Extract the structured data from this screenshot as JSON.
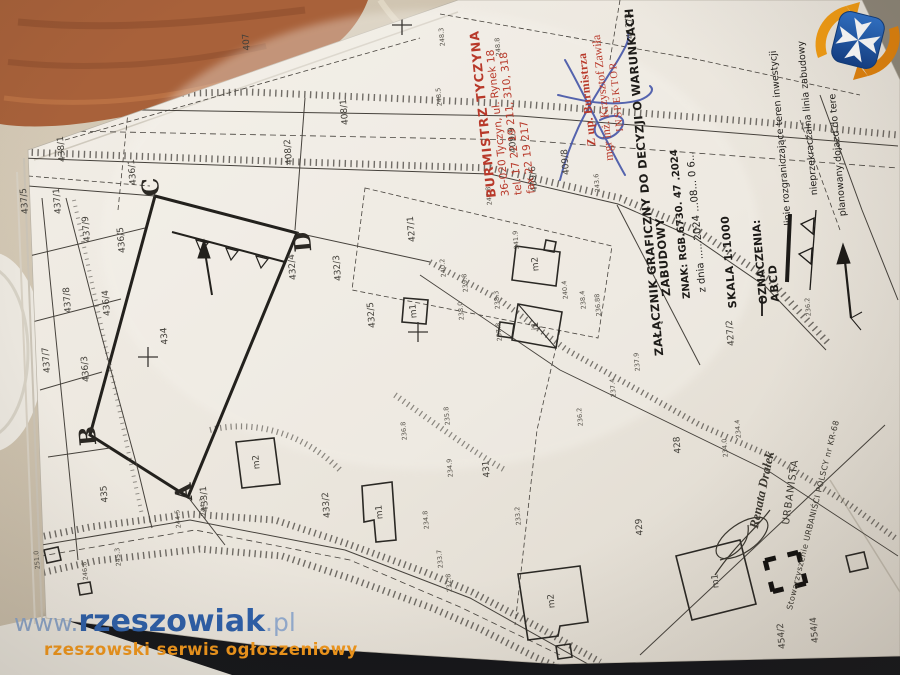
{
  "watermark": {
    "prefix": "www.",
    "name": "rzeszowiak",
    "suffix": ".pl",
    "tagline": "rzeszowski serwis ogłoszeniowy",
    "url_color": "#2d5fa8",
    "tagline_color": "#f0961b"
  },
  "logo": {
    "name": "rzeszow-crest-logo",
    "shield_color": "#1c55a8",
    "cross_color": "#ffffff",
    "swirl_color": "#f29c13"
  },
  "stamps": {
    "mayor_stamp": {
      "color": "#b8392a",
      "lines": [
        "BURMISTRZ TYCZYNA",
        "36-020 Tyczyn, ul. Rynek 18",
        "tel. 17 22 19 211, 310, 318",
        "fax 22 19 217"
      ]
    },
    "deputy_stamp": {
      "color": "#b8392a",
      "lines": [
        "Z up. Burmistrza",
        "mgr inż. Krzysztof Zawiła",
        "INSPEKTOR"
      ],
      "signature_color": "#4455a8"
    },
    "urbanist_stamp": {
      "name": "Renata Drałek",
      "role": "URBANISTA",
      "org": "Stowarzyszenie URBANIŚCI POLSCY nr KR-68"
    }
  },
  "title_block": {
    "line1": "ZAŁĄCZNIK GRAFICZNY DO DECYZJI O WARUNKACH",
    "line2": "ZABUDOWY",
    "znak": "ZNAK: RGB.6730. 47 .2024",
    "date_line": "z dnia ......2024 ...08... 0 6...",
    "scale": "SKALA 1:1000",
    "legend_header": "OZNACZENIA:",
    "abcd": "ABCD",
    "legend": [
      {
        "symbol": "boundary-thick-line",
        "label": "linie rozgraniczające teren inwestycji"
      },
      {
        "symbol": "triangle-line",
        "label": "nieprzekraczalna linia zabudowy"
      },
      {
        "symbol": "arrow",
        "label": "planowany dojazd do tere"
      }
    ]
  },
  "map": {
    "scale_text": "1:1000",
    "corner_letters": [
      {
        "t": "A",
        "x": 184,
        "y": 492
      },
      {
        "t": "B",
        "x": 88,
        "y": 436
      },
      {
        "t": "C",
        "x": 151,
        "y": 187
      },
      {
        "t": "D",
        "x": 303,
        "y": 242
      }
    ],
    "parcel_labels": [
      {
        "t": "407",
        "x": 247,
        "y": 42
      },
      {
        "t": "408/2",
        "x": 289,
        "y": 152
      },
      {
        "t": "408/1",
        "x": 345,
        "y": 112
      },
      {
        "t": "409/9",
        "x": 513,
        "y": 140
      },
      {
        "t": "409/6",
        "x": 534,
        "y": 179
      },
      {
        "t": "409/8",
        "x": 566,
        "y": 162
      },
      {
        "t": "412/2",
        "x": 630,
        "y": 26
      },
      {
        "t": "427/1",
        "x": 412,
        "y": 229
      },
      {
        "t": "427/2",
        "x": 731,
        "y": 333
      },
      {
        "t": "428",
        "x": 678,
        "y": 445
      },
      {
        "t": "429",
        "x": 640,
        "y": 527
      },
      {
        "t": "431",
        "x": 487,
        "y": 469
      },
      {
        "t": "432/3",
        "x": 338,
        "y": 268
      },
      {
        "t": "432/4",
        "x": 293,
        "y": 267
      },
      {
        "t": "432/5",
        "x": 372,
        "y": 315
      },
      {
        "t": "433/1",
        "x": 205,
        "y": 499
      },
      {
        "t": "433/2",
        "x": 327,
        "y": 505
      },
      {
        "t": "434",
        "x": 165,
        "y": 336
      },
      {
        "t": "435",
        "x": 105,
        "y": 494
      },
      {
        "t": "436/1",
        "x": 133,
        "y": 172
      },
      {
        "t": "436/3",
        "x": 86,
        "y": 369
      },
      {
        "t": "436/4",
        "x": 107,
        "y": 303
      },
      {
        "t": "436/5",
        "x": 122,
        "y": 240
      },
      {
        "t": "437/1",
        "x": 58,
        "y": 201
      },
      {
        "t": "437/5",
        "x": 25,
        "y": 201
      },
      {
        "t": "437/7",
        "x": 47,
        "y": 360
      },
      {
        "t": "437/8",
        "x": 68,
        "y": 300
      },
      {
        "t": "437/9",
        "x": 87,
        "y": 229
      },
      {
        "t": "438/1",
        "x": 62,
        "y": 149
      },
      {
        "t": "454/2",
        "x": 782,
        "y": 636
      },
      {
        "t": "454/4",
        "x": 815,
        "y": 630
      }
    ],
    "elevation_labels": [
      {
        "t": "248.3",
        "x": 442,
        "y": 37
      },
      {
        "t": "248.8",
        "x": 498,
        "y": 47
      },
      {
        "t": "248.5",
        "x": 439,
        "y": 97
      },
      {
        "t": "247.8",
        "x": 489,
        "y": 196
      },
      {
        "t": "243.6",
        "x": 597,
        "y": 183
      },
      {
        "t": "241.9",
        "x": 516,
        "y": 240
      },
      {
        "t": "240.2",
        "x": 443,
        "y": 268
      },
      {
        "t": "239.8",
        "x": 465,
        "y": 283
      },
      {
        "t": "238.3",
        "x": 497,
        "y": 300
      },
      {
        "t": "238.0",
        "x": 461,
        "y": 311
      },
      {
        "t": "237.8",
        "x": 499,
        "y": 332
      },
      {
        "t": "240.4",
        "x": 565,
        "y": 290
      },
      {
        "t": "238.4",
        "x": 583,
        "y": 300
      },
      {
        "t": "236.88",
        "x": 598,
        "y": 305
      },
      {
        "t": "237.9",
        "x": 637,
        "y": 362
      },
      {
        "t": "237.4",
        "x": 613,
        "y": 388
      },
      {
        "t": "236.2",
        "x": 580,
        "y": 417
      },
      {
        "t": "236.2",
        "x": 808,
        "y": 307
      },
      {
        "t": "236.8",
        "x": 404,
        "y": 431
      },
      {
        "t": "235.8",
        "x": 447,
        "y": 416
      },
      {
        "t": "234.9",
        "x": 450,
        "y": 468
      },
      {
        "t": "234.8",
        "x": 426,
        "y": 520
      },
      {
        "t": "233.7",
        "x": 440,
        "y": 559
      },
      {
        "t": "233.2",
        "x": 518,
        "y": 516
      },
      {
        "t": "232.8",
        "x": 449,
        "y": 583
      },
      {
        "t": "234.4",
        "x": 738,
        "y": 429
      },
      {
        "t": "234.0",
        "x": 725,
        "y": 448
      },
      {
        "t": "246.8",
        "x": 85,
        "y": 571
      },
      {
        "t": "245.3",
        "x": 118,
        "y": 557
      },
      {
        "t": "251.0",
        "x": 37,
        "y": 560
      },
      {
        "t": "244.3",
        "x": 203,
        "y": 507
      },
      {
        "t": "244.5",
        "x": 178,
        "y": 519
      }
    ],
    "building_labels": [
      {
        "t": "m2",
        "x": 536,
        "y": 264
      },
      {
        "t": "m1",
        "x": 414,
        "y": 311
      },
      {
        "t": "i1",
        "x": 536,
        "y": 326
      },
      {
        "t": "m1",
        "x": 380,
        "y": 512
      },
      {
        "t": "m2",
        "x": 552,
        "y": 601
      },
      {
        "t": "m2",
        "x": 257,
        "y": 462
      },
      {
        "t": "m1",
        "x": 716,
        "y": 581
      }
    ]
  }
}
